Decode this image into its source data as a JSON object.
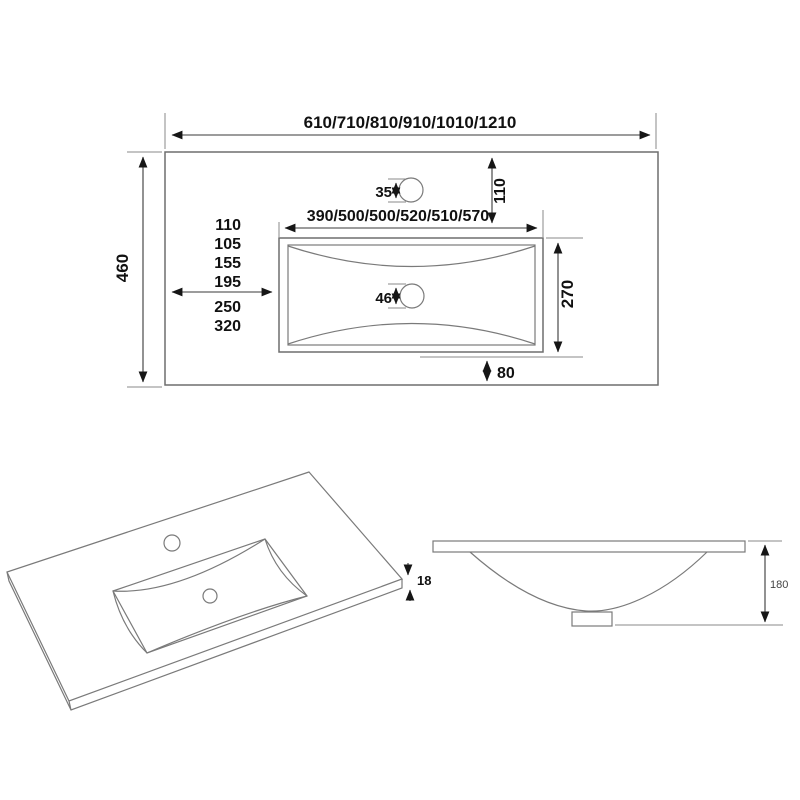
{
  "plan_view": {
    "overall_width_label": "610/710/810/910/1010/1210",
    "overall_depth_label": "460",
    "basin_width_label": "390/500/500/520/510/570",
    "basin_depth_label": "270",
    "faucet_back_offset_label": "110",
    "faucet_hole_diameter_label": "35",
    "drain_hole_diameter_label": "46",
    "front_edge_offset_label": "80",
    "left_offset_labels": [
      "110",
      "105",
      "155",
      "195",
      "250",
      "320"
    ]
  },
  "iso_view": {
    "edge_thickness_label": "18"
  },
  "side_view": {
    "basin_height_label": "180"
  },
  "colors": {
    "line_gray": "#6e6e6e",
    "dim_dark": "#3a3a3a",
    "text_black": "#111111",
    "background": "#ffffff"
  }
}
